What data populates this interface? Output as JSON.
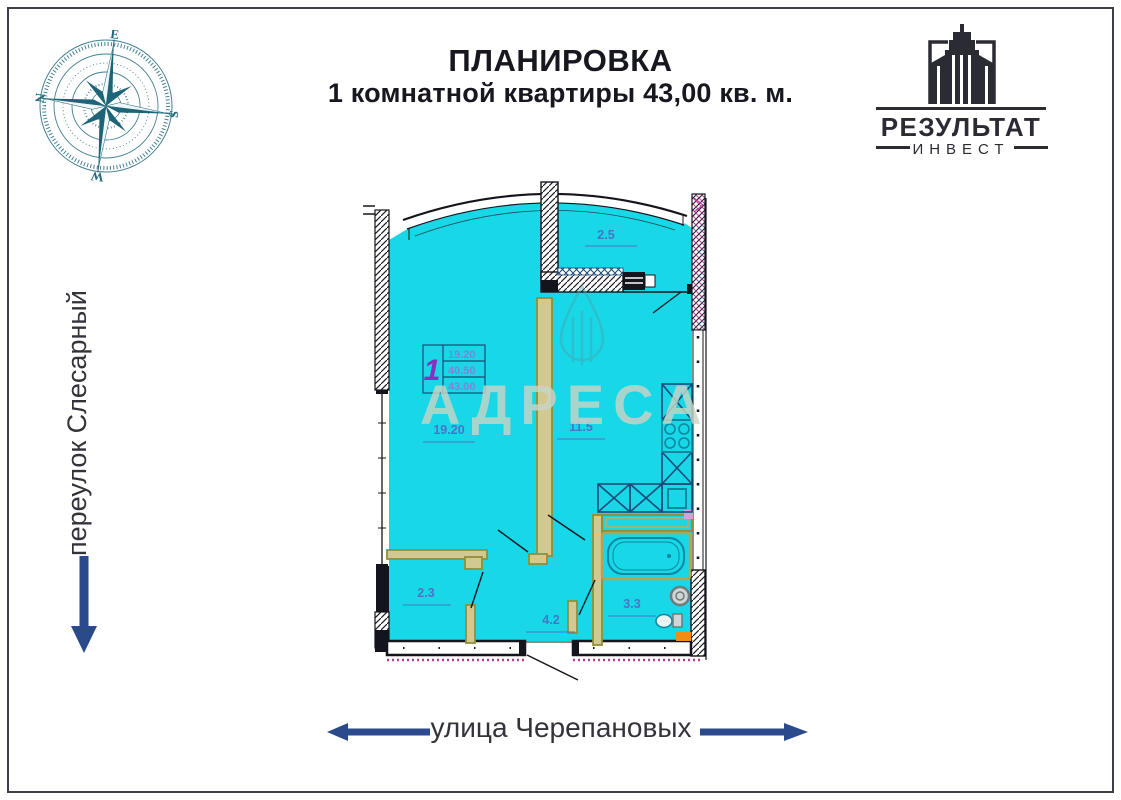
{
  "header": {
    "title_line1": "ПЛАНИРОВКА",
    "title_line2": "1 комнатной квартиры 43,00 кв. м."
  },
  "compass": {
    "top": "E",
    "right": "S",
    "bottom": "W",
    "left": "N",
    "color": "#226a80"
  },
  "logo": {
    "line1": "РЕЗУЛЬТАТ",
    "line2": "ИНВЕСТ",
    "color": "#2b2b33"
  },
  "streets": {
    "left_label": "переулок Слесарный",
    "left_arrow_direction": "down",
    "bottom_label": "улица Черепановых",
    "bottom_arrow_directions": [
      "left",
      "right"
    ],
    "arrow_color": "#2a4a8c"
  },
  "plan": {
    "rooms": [
      {
        "id": "balcony",
        "area": "2.5"
      },
      {
        "id": "living-room",
        "area": "19.20"
      },
      {
        "id": "kitchen",
        "area": "11.5"
      },
      {
        "id": "closet",
        "area": "2.3"
      },
      {
        "id": "hallway",
        "area": "4.2"
      },
      {
        "id": "bathroom",
        "area": "3.3"
      }
    ],
    "info_box": {
      "number": "1",
      "row1": "19.20",
      "row2": "40.50",
      "row3": "43.00"
    },
    "colors": {
      "room_fill": "#18d7e6",
      "label_blue": "#4a74c8",
      "wall_dark": "#14141c",
      "partition_olive": "#8f9038",
      "magenta_accent": "#b8399b",
      "fixture_teal": "#0b87a0",
      "fixture_navy": "#1b4a78",
      "info_number_purple": "#8a2fc0"
    }
  },
  "watermark": {
    "text": "АДРЕСА"
  }
}
